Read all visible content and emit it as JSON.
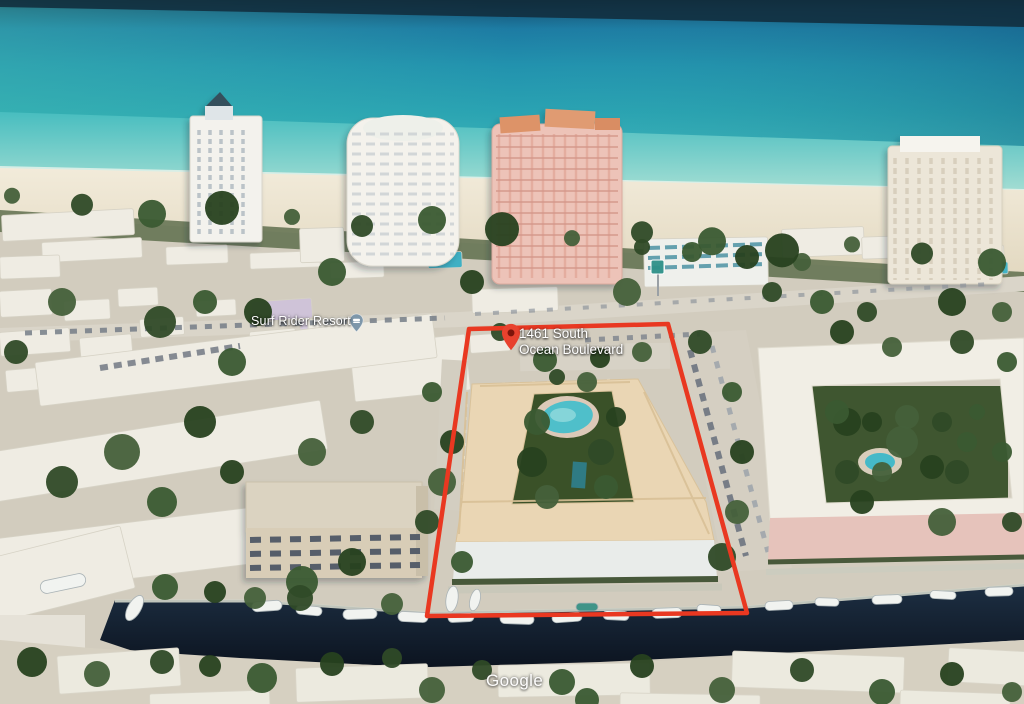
{
  "watermark": {
    "text": "Google"
  },
  "markers": {
    "property": {
      "label_line1": "1461 South",
      "label_line2": "Ocean Boulevard",
      "icon": "map-pin-red",
      "pin_color": "#e8422e"
    },
    "resort": {
      "label": "Surf Rider Resort",
      "icon": "lodging-pin",
      "pin_color": "#7e97aa"
    }
  },
  "annotation": {
    "boundary_color": "#e93821"
  },
  "palette": {
    "ocean_deep": "#1d7ba3",
    "ocean_teal": "#2aa3b2",
    "shallow_water": "#7fd3cb",
    "sand": "#ece4d1",
    "land": "#d2ccbe",
    "canal_water": "#13202e",
    "property_roof": "#ead6b4",
    "pool": "#4fbfca",
    "boundary_red": "#e93821"
  }
}
